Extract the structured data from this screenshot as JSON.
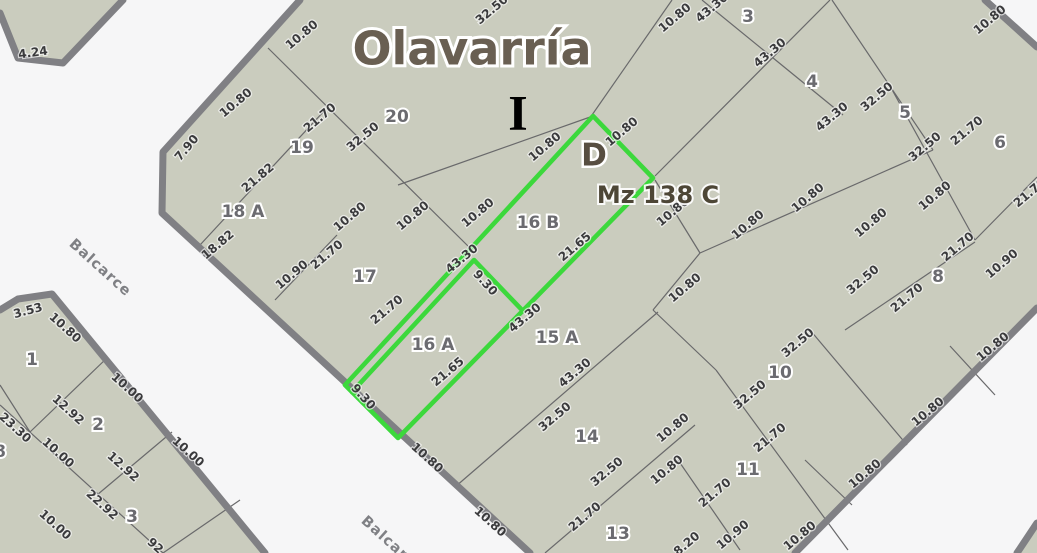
{
  "map": {
    "title": "Olavarría",
    "section_marker": "I",
    "corner_marker": "D",
    "block_label": "Mz 138 C",
    "street_labels": [
      {
        "t": "Balcarce",
        "x": 100,
        "y": 268,
        "r": 42
      },
      {
        "t": "Balcarce",
        "x": 392,
        "y": 545,
        "r": 42
      }
    ],
    "colors": {
      "street_bg": "#f6f6f7",
      "parcel_fill": "#caccbe",
      "block_border": "#808084",
      "thin_line": "#69696b",
      "highlight_green": "#3cd83c",
      "dim_text": "#3a3a3c",
      "parcel_num_text": "#6b6b70",
      "title_text": "#695f52"
    },
    "blocks": [
      {
        "name": "main-block",
        "fill": [
          [
            300,
            0
          ],
          [
            985,
            0
          ],
          [
            1037,
            47
          ],
          [
            1037,
            308
          ],
          [
            795,
            553
          ],
          [
            530,
            553
          ],
          [
            162,
            213
          ],
          [
            163,
            152
          ]
        ]
      },
      {
        "name": "corner-block-top-left",
        "fill": [
          [
            0,
            0
          ],
          [
            123,
            0
          ],
          [
            63,
            63
          ],
          [
            18,
            58
          ],
          [
            0,
            13
          ]
        ]
      },
      {
        "name": "block-bottom-left",
        "fill": [
          [
            0,
            310
          ],
          [
            18,
            299
          ],
          [
            52,
            294
          ],
          [
            265,
            553
          ],
          [
            0,
            553
          ]
        ]
      },
      {
        "name": "corner-block-bottom-right",
        "fill": [
          [
            1017,
            553
          ],
          [
            1037,
            523
          ],
          [
            1037,
            553
          ]
        ]
      }
    ],
    "thick_edges": [
      [
        [
          300,
          0
        ],
        [
          163,
          152
        ],
        [
          162,
          213
        ],
        [
          530,
          553
        ]
      ],
      [
        [
          985,
          0
        ],
        [
          1037,
          47
        ]
      ],
      [
        [
          1037,
          308
        ],
        [
          795,
          553
        ]
      ],
      [
        [
          123,
          0
        ],
        [
          63,
          63
        ],
        [
          18,
          58
        ],
        [
          0,
          13
        ]
      ],
      [
        [
          0,
          310
        ],
        [
          18,
          299
        ],
        [
          52,
          294
        ],
        [
          265,
          553
        ]
      ],
      [
        [
          1017,
          553
        ],
        [
          1037,
          523
        ]
      ]
    ],
    "thin_lines": [
      [
        268,
        48,
        472,
        250
      ],
      [
        398,
        185,
        593,
        116
      ],
      [
        592,
        115,
        672,
        0
      ],
      [
        655,
        176,
        830,
        0
      ],
      [
        702,
        0,
        843,
        115
      ],
      [
        832,
        0,
        933,
        150
      ],
      [
        890,
        86,
        975,
        240
      ],
      [
        700,
        253,
        933,
        150
      ],
      [
        975,
        240,
        1037,
        177
      ],
      [
        845,
        330,
        975,
        242
      ],
      [
        655,
        180,
        700,
        253
      ],
      [
        700,
        253,
        653,
        310
      ],
      [
        653,
        310,
        716,
        370
      ],
      [
        455,
        487,
        658,
        312
      ],
      [
        810,
        330,
        907,
        445
      ],
      [
        716,
        370,
        848,
        550
      ],
      [
        678,
        460,
        740,
        550
      ],
      [
        805,
        460,
        852,
        505
      ],
      [
        950,
        346,
        995,
        395
      ],
      [
        545,
        553,
        695,
        425
      ],
      [
        200,
        245,
        325,
        110
      ],
      [
        275,
        300,
        337,
        235
      ],
      [
        108,
        357,
        30,
        432
      ],
      [
        0,
        405,
        163,
        553
      ],
      [
        172,
        432,
        97,
        495
      ],
      [
        240,
        500,
        163,
        553
      ],
      [
        0,
        385,
        30,
        432
      ]
    ],
    "highlight": {
      "outline": [
        [
          345,
          385
        ],
        [
          593,
          116
        ],
        [
          653,
          178
        ],
        [
          398,
          438
        ]
      ],
      "inner_path": [
        [
          352,
          392
        ],
        [
          474,
          260
        ],
        [
          523,
          311
        ]
      ]
    },
    "parcel_numbers": [
      {
        "t": "1",
        "x": 32,
        "y": 360
      },
      {
        "t": "2",
        "x": 98,
        "y": 425
      },
      {
        "t": "3",
        "x": 132,
        "y": 517
      },
      {
        "t": "8",
        "x": 0,
        "y": 452
      },
      {
        "t": "19",
        "x": 302,
        "y": 148
      },
      {
        "t": "20",
        "x": 397,
        "y": 117
      },
      {
        "t": "18 A",
        "x": 243,
        "y": 212
      },
      {
        "t": "17",
        "x": 365,
        "y": 277
      },
      {
        "t": "16 B",
        "x": 538,
        "y": 223
      },
      {
        "t": "16 A",
        "x": 433,
        "y": 345
      },
      {
        "t": "15 A",
        "x": 557,
        "y": 338
      },
      {
        "t": "14",
        "x": 587,
        "y": 437
      },
      {
        "t": "13",
        "x": 618,
        "y": 534
      },
      {
        "t": "3",
        "x": 748,
        "y": 17
      },
      {
        "t": "4",
        "x": 812,
        "y": 82
      },
      {
        "t": "5",
        "x": 905,
        "y": 113
      },
      {
        "t": "6",
        "x": 1000,
        "y": 143
      },
      {
        "t": "8",
        "x": 938,
        "y": 277
      },
      {
        "t": "10",
        "x": 780,
        "y": 373
      },
      {
        "t": "11",
        "x": 748,
        "y": 470
      }
    ],
    "dimension_labels": [
      {
        "t": "4.24",
        "x": 33,
        "y": 53,
        "r": -8
      },
      {
        "t": "3.53",
        "x": 28,
        "y": 311,
        "r": -15
      },
      {
        "t": "10.80",
        "x": 302,
        "y": 35,
        "r": -40
      },
      {
        "t": "10.80",
        "x": 236,
        "y": 103,
        "r": -40
      },
      {
        "t": "7.90",
        "x": 187,
        "y": 148,
        "r": -50
      },
      {
        "t": "21.70",
        "x": 320,
        "y": 118,
        "r": -40
      },
      {
        "t": "32.50",
        "x": 363,
        "y": 137,
        "r": -40
      },
      {
        "t": "32.50",
        "x": 492,
        "y": 10,
        "r": -40
      },
      {
        "t": "21.82",
        "x": 258,
        "y": 178,
        "r": -40
      },
      {
        "t": "18.82",
        "x": 218,
        "y": 245,
        "r": -40
      },
      {
        "t": "10.90",
        "x": 292,
        "y": 275,
        "r": -40
      },
      {
        "t": "21.70",
        "x": 327,
        "y": 255,
        "r": -40
      },
      {
        "t": "10.80",
        "x": 350,
        "y": 217,
        "r": -40
      },
      {
        "t": "10.80",
        "x": 413,
        "y": 216,
        "r": -40
      },
      {
        "t": "10.80",
        "x": 478,
        "y": 213,
        "r": -40
      },
      {
        "t": "21.70",
        "x": 387,
        "y": 310,
        "r": -40
      },
      {
        "t": "10.80",
        "x": 545,
        "y": 147,
        "r": -40
      },
      {
        "t": "10.80",
        "x": 622,
        "y": 132,
        "r": -40
      },
      {
        "t": "43.30",
        "x": 462,
        "y": 259,
        "r": -40
      },
      {
        "t": "9.30",
        "x": 485,
        "y": 283,
        "r": 48
      },
      {
        "t": "21.65",
        "x": 575,
        "y": 247,
        "r": -40
      },
      {
        "t": "9.30",
        "x": 363,
        "y": 397,
        "r": 48
      },
      {
        "t": "21.65",
        "x": 448,
        "y": 372,
        "r": -40
      },
      {
        "t": "43.30",
        "x": 525,
        "y": 318,
        "r": -40
      },
      {
        "t": "10.80",
        "x": 673,
        "y": 212,
        "r": -40
      },
      {
        "t": "10.80",
        "x": 685,
        "y": 288,
        "r": -40
      },
      {
        "t": "10.80",
        "x": 675,
        "y": 18,
        "r": -40
      },
      {
        "t": "43.30",
        "x": 712,
        "y": 8,
        "r": -40
      },
      {
        "t": "43.30",
        "x": 770,
        "y": 53,
        "r": -40
      },
      {
        "t": "43.30",
        "x": 832,
        "y": 117,
        "r": -40
      },
      {
        "t": "32.50",
        "x": 877,
        "y": 97,
        "r": -40
      },
      {
        "t": "32.50",
        "x": 925,
        "y": 147,
        "r": -40
      },
      {
        "t": "21.70",
        "x": 967,
        "y": 131,
        "r": -40
      },
      {
        "t": "10.80",
        "x": 990,
        "y": 20,
        "r": -40
      },
      {
        "t": "21.70",
        "x": 1030,
        "y": 193,
        "r": -40
      },
      {
        "t": "10.80",
        "x": 748,
        "y": 225,
        "r": -40
      },
      {
        "t": "10.80",
        "x": 808,
        "y": 198,
        "r": -40
      },
      {
        "t": "10.80",
        "x": 871,
        "y": 223,
        "r": -40
      },
      {
        "t": "10.80",
        "x": 935,
        "y": 196,
        "r": -40
      },
      {
        "t": "32.50",
        "x": 863,
        "y": 280,
        "r": -40
      },
      {
        "t": "21.70",
        "x": 907,
        "y": 298,
        "r": -40
      },
      {
        "t": "21.70",
        "x": 958,
        "y": 247,
        "r": -40
      },
      {
        "t": "10.90",
        "x": 1002,
        "y": 264,
        "r": -40
      },
      {
        "t": "32.50",
        "x": 798,
        "y": 343,
        "r": -40
      },
      {
        "t": "32.50",
        "x": 750,
        "y": 395,
        "r": -40
      },
      {
        "t": "21.70",
        "x": 770,
        "y": 438,
        "r": -40
      },
      {
        "t": "43.30",
        "x": 575,
        "y": 373,
        "r": -40
      },
      {
        "t": "32.50",
        "x": 555,
        "y": 417,
        "r": -40
      },
      {
        "t": "10.80",
        "x": 427,
        "y": 458,
        "r": 42
      },
      {
        "t": "10.80",
        "x": 490,
        "y": 522,
        "r": 42
      },
      {
        "t": "10.80",
        "x": 673,
        "y": 428,
        "r": -40
      },
      {
        "t": "32.50",
        "x": 607,
        "y": 472,
        "r": -40
      },
      {
        "t": "10.80",
        "x": 667,
        "y": 470,
        "r": -40
      },
      {
        "t": "21.70",
        "x": 715,
        "y": 493,
        "r": -40
      },
      {
        "t": "21.70",
        "x": 585,
        "y": 517,
        "r": -40
      },
      {
        "t": "10.90",
        "x": 733,
        "y": 535,
        "r": -40
      },
      {
        "t": "8.20",
        "x": 687,
        "y": 544,
        "r": -40
      },
      {
        "t": "10.80",
        "x": 865,
        "y": 474,
        "r": -40
      },
      {
        "t": "10.80",
        "x": 800,
        "y": 536,
        "r": -40
      },
      {
        "t": "10.80",
        "x": 928,
        "y": 412,
        "r": -40
      },
      {
        "t": "10.80",
        "x": 993,
        "y": 347,
        "r": -40
      },
      {
        "t": "10.80",
        "x": 65,
        "y": 328,
        "r": 42
      },
      {
        "t": "12.92",
        "x": 68,
        "y": 410,
        "r": 42
      },
      {
        "t": "10.00",
        "x": 127,
        "y": 388,
        "r": 42
      },
      {
        "t": "23.30",
        "x": 15,
        "y": 428,
        "r": 42
      },
      {
        "t": "10.00",
        "x": 58,
        "y": 453,
        "r": 42
      },
      {
        "t": "12.92",
        "x": 123,
        "y": 467,
        "r": 42
      },
      {
        "t": "10.00",
        "x": 188,
        "y": 452,
        "r": 42
      },
      {
        "t": "22.92",
        "x": 102,
        "y": 505,
        "r": 42
      },
      {
        "t": "10.00",
        "x": 55,
        "y": 525,
        "r": 42
      },
      {
        "t": "92",
        "x": 155,
        "y": 546,
        "r": 42
      }
    ],
    "title_pos": {
      "x": 472,
      "y": 52
    },
    "section_marker_pos": {
      "x": 518,
      "y": 118
    },
    "corner_marker_pos": {
      "x": 594,
      "y": 157
    },
    "block_label_pos": {
      "x": 658,
      "y": 196
    }
  }
}
